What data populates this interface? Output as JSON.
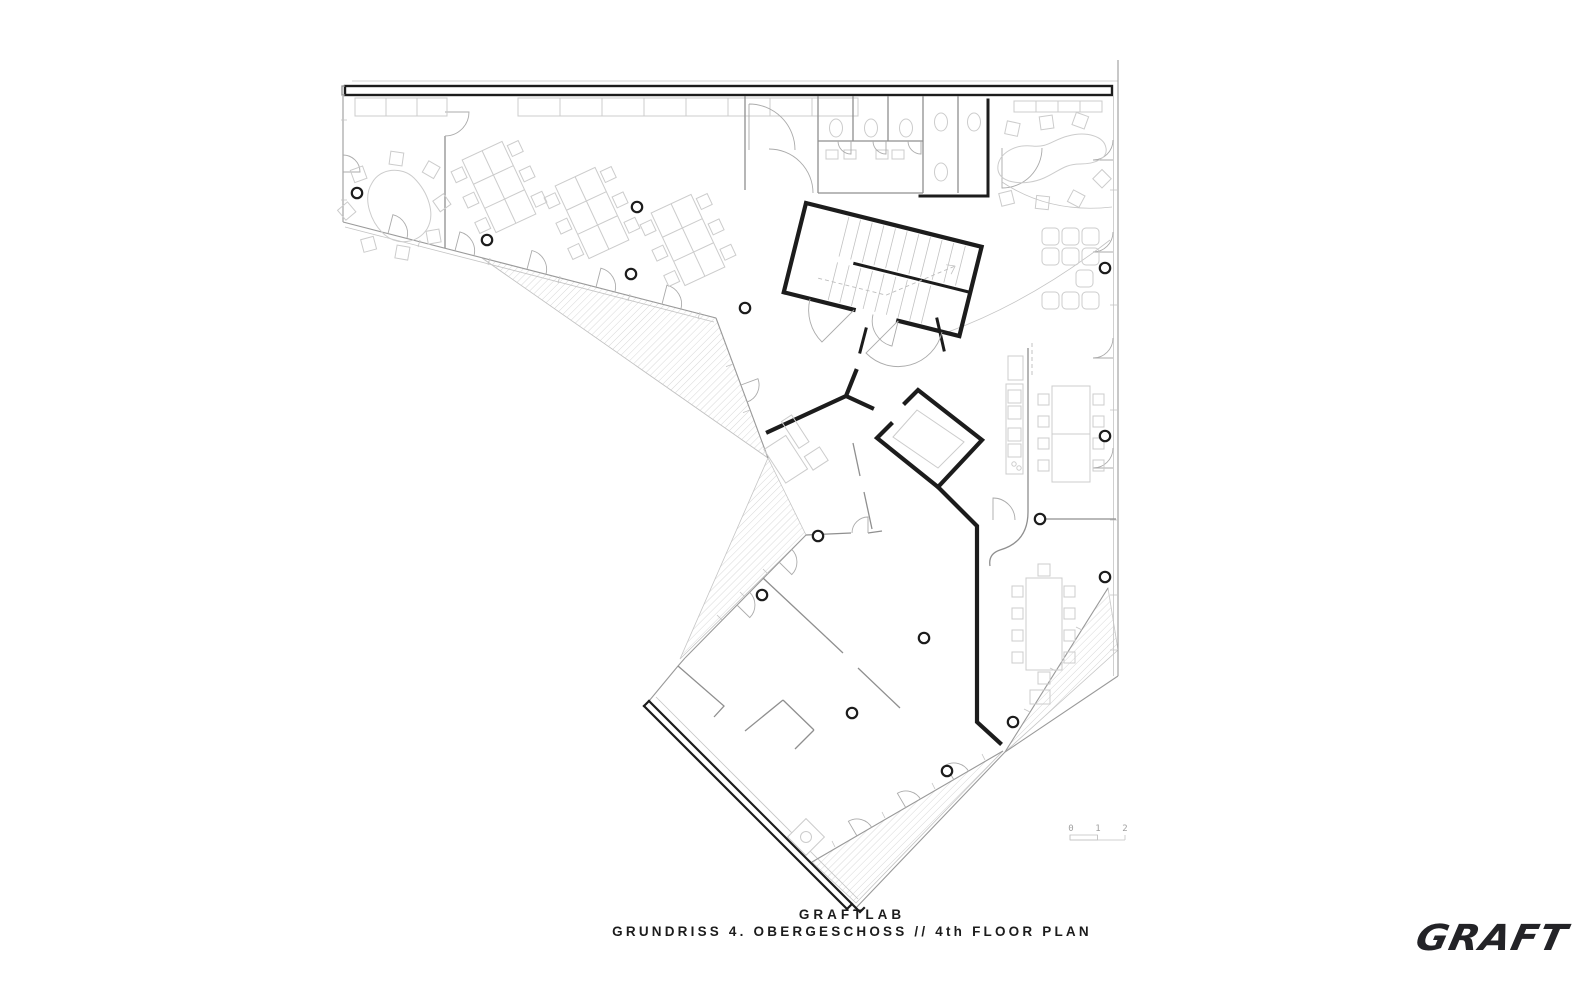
{
  "drawing": {
    "type": "architectural-floor-plan"
  },
  "title_block": {
    "line1": "GRAFTLAB",
    "line2": "GRUNDRISS 4. OBERGESCHOSS // 4th FLOOR PLAN"
  },
  "scale_bar": {
    "labels": [
      "0",
      "1",
      "2"
    ]
  },
  "logo": {
    "wordmark": "GRAFT"
  },
  "colors": {
    "paper": "#ffffff",
    "wall": "#1c1c1c",
    "partition": "#8f8f8f",
    "glass_facade": "#9a9a9a",
    "furniture_line": "#cccccc",
    "hatch_line": "#d8d8d8",
    "text": "#1c1c1c",
    "scale_text": "#a0a0a0"
  }
}
